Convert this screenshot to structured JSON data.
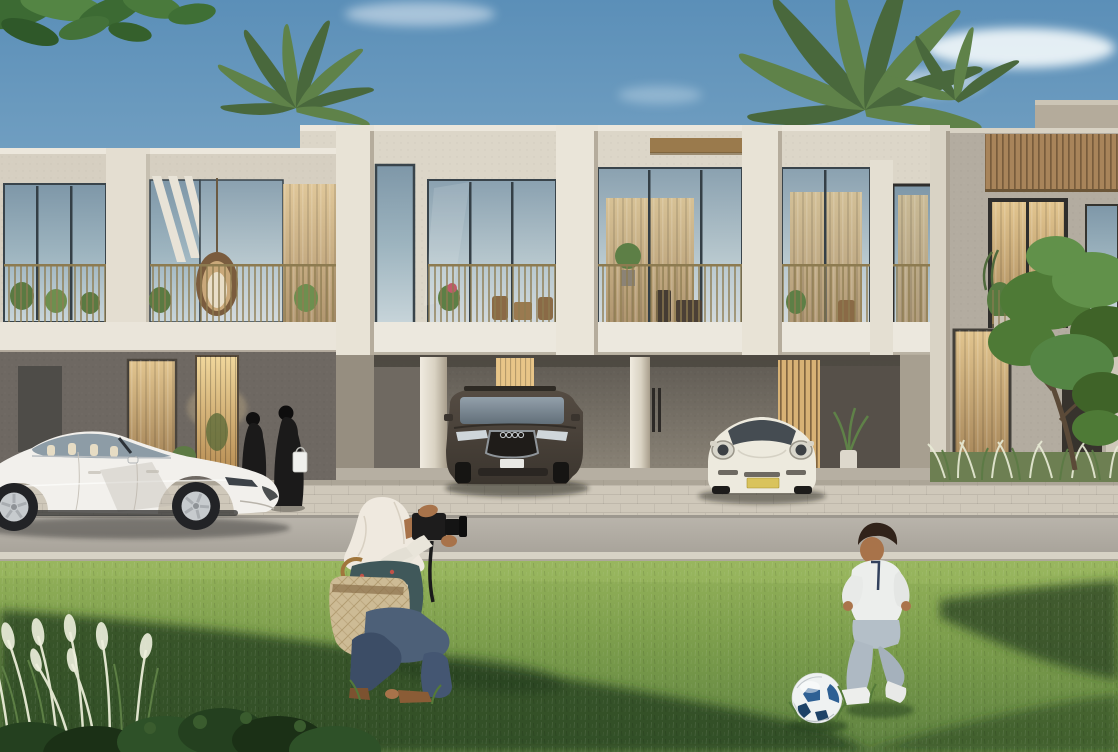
{
  "canvas": {
    "width": 1118,
    "height": 752
  },
  "scene": {
    "setting": "sunny-residential-street",
    "objects": [
      {
        "name": "sky",
        "label": "clear blue sky with soft clouds"
      },
      {
        "name": "tree-canopy-overhang",
        "label": "green leaves overhanging top-left corner"
      },
      {
        "name": "palm-trees",
        "label": "palm crowns rising behind the roofline"
      },
      {
        "name": "townhouse-row",
        "label": "modern two-storey townhouses in cream concrete"
      },
      {
        "name": "balconies",
        "label": "first-floor balconies with plants and rattan furniture"
      },
      {
        "name": "hanging-egg-chair",
        "label": "rattan egg chair hanging on left balcony"
      },
      {
        "name": "timber-slat-cladding",
        "label": "vertical timber slats on right house"
      },
      {
        "name": "carport",
        "label": "recessed ground-floor carport"
      },
      {
        "name": "white-sedan",
        "label": "white electric sedan parked on street, facing right"
      },
      {
        "name": "dark-suv",
        "label": "dark grey SUV parked in carport"
      },
      {
        "name": "white-sports-coupe",
        "label": "white sports coupe with yellow plate in carport"
      },
      {
        "name": "women-in-abayas",
        "label": "two women in black abayas walking to entrance"
      },
      {
        "name": "shopping-bag",
        "label": "white shopping bag carried by woman"
      },
      {
        "name": "photographer",
        "label": "crouching woman in white hijab taking a photo"
      },
      {
        "name": "camera",
        "label": "black camera with zoom lens and strap"
      },
      {
        "name": "shoulder-bag",
        "label": "beige monogram shoulder bag"
      },
      {
        "name": "boy",
        "label": "small boy in white shirt kicking a football"
      },
      {
        "name": "football",
        "label": "white and blue football on the lawn"
      },
      {
        "name": "street",
        "label": "paved apron, asphalt road and curb"
      },
      {
        "name": "lawn",
        "label": "sunlit lawn with long tree shadows"
      },
      {
        "name": "ornamental-grasses",
        "label": "white-plumed ornamental grasses"
      },
      {
        "name": "foreground-shrub",
        "label": "dark shrub along bottom edge"
      },
      {
        "name": "street-tree",
        "label": "leafy tree beside right house"
      }
    ]
  },
  "palette": {
    "sky_top": "#5b8fb8",
    "sky_mid": "#7fa9c7",
    "sky_horizon": "#bed5e2",
    "cloud": "#f3f8fb",
    "facade_left": "#d6cfc1",
    "facade_center": "#dcd6c8",
    "facade_right": "#b3aca0",
    "parapet_highlight": "#ece7dc",
    "pier_white": "#e8e3d6",
    "slab_white": "#ece8de",
    "glass_top": "#7e97a8",
    "glass_bottom": "#c8d5da",
    "glass_frame": "#39444b",
    "curtain_top": "#e2c58f",
    "curtain_bottom": "#a9895c",
    "door_glow": "#f0d79c",
    "railing_gold": "#8d7b50",
    "bronze_trim": "#9a7a4c",
    "wood_slat": "#a8845a",
    "wood_slat_gap": "#6b5335",
    "carport_top": "#5e5952",
    "carport_bottom": "#8d8679",
    "column_light": "#f0ebe0",
    "palm_green": "#5f8249",
    "palm_dark": "#49683c",
    "canopy_green": "#3c6a33",
    "tree_green": "#4e7a36",
    "sidewalk": "#cfc8ba",
    "road": "#b6b1a8",
    "curb": "#d7d2c5",
    "grass_top": "#94b25a",
    "grass_mid": "#7a9c4b",
    "grass_bottom": "#5e8140",
    "grass_shadow": "#274220",
    "grass_highlight": "#a3c166",
    "plume": "#e9ecd6",
    "bush_dark": "#24401f",
    "sedan_white": "#f2f0ec",
    "suv_top": "#554c43",
    "suv_bottom": "#3b352e",
    "coupe_white": "#edeade",
    "plate_yellow": "#d9c35c",
    "tire_black": "#222326",
    "rim_silver": "#c7cbce",
    "abaya_black": "#1b1a1a",
    "hijab_white": "#efe9df",
    "blouse_teal": "#40585a",
    "jeans_blue": "#4d6078",
    "bag_beige": "#cdbb95",
    "skin_tan": "#a8734a",
    "boy_shirt": "#eceeec",
    "boy_pants": "#b4bfc8",
    "ball_white": "#eff2f2",
    "ball_blue": "#2e6094",
    "ball_navy": "#1d4267",
    "shadow_dark": "#1e1e1c"
  }
}
